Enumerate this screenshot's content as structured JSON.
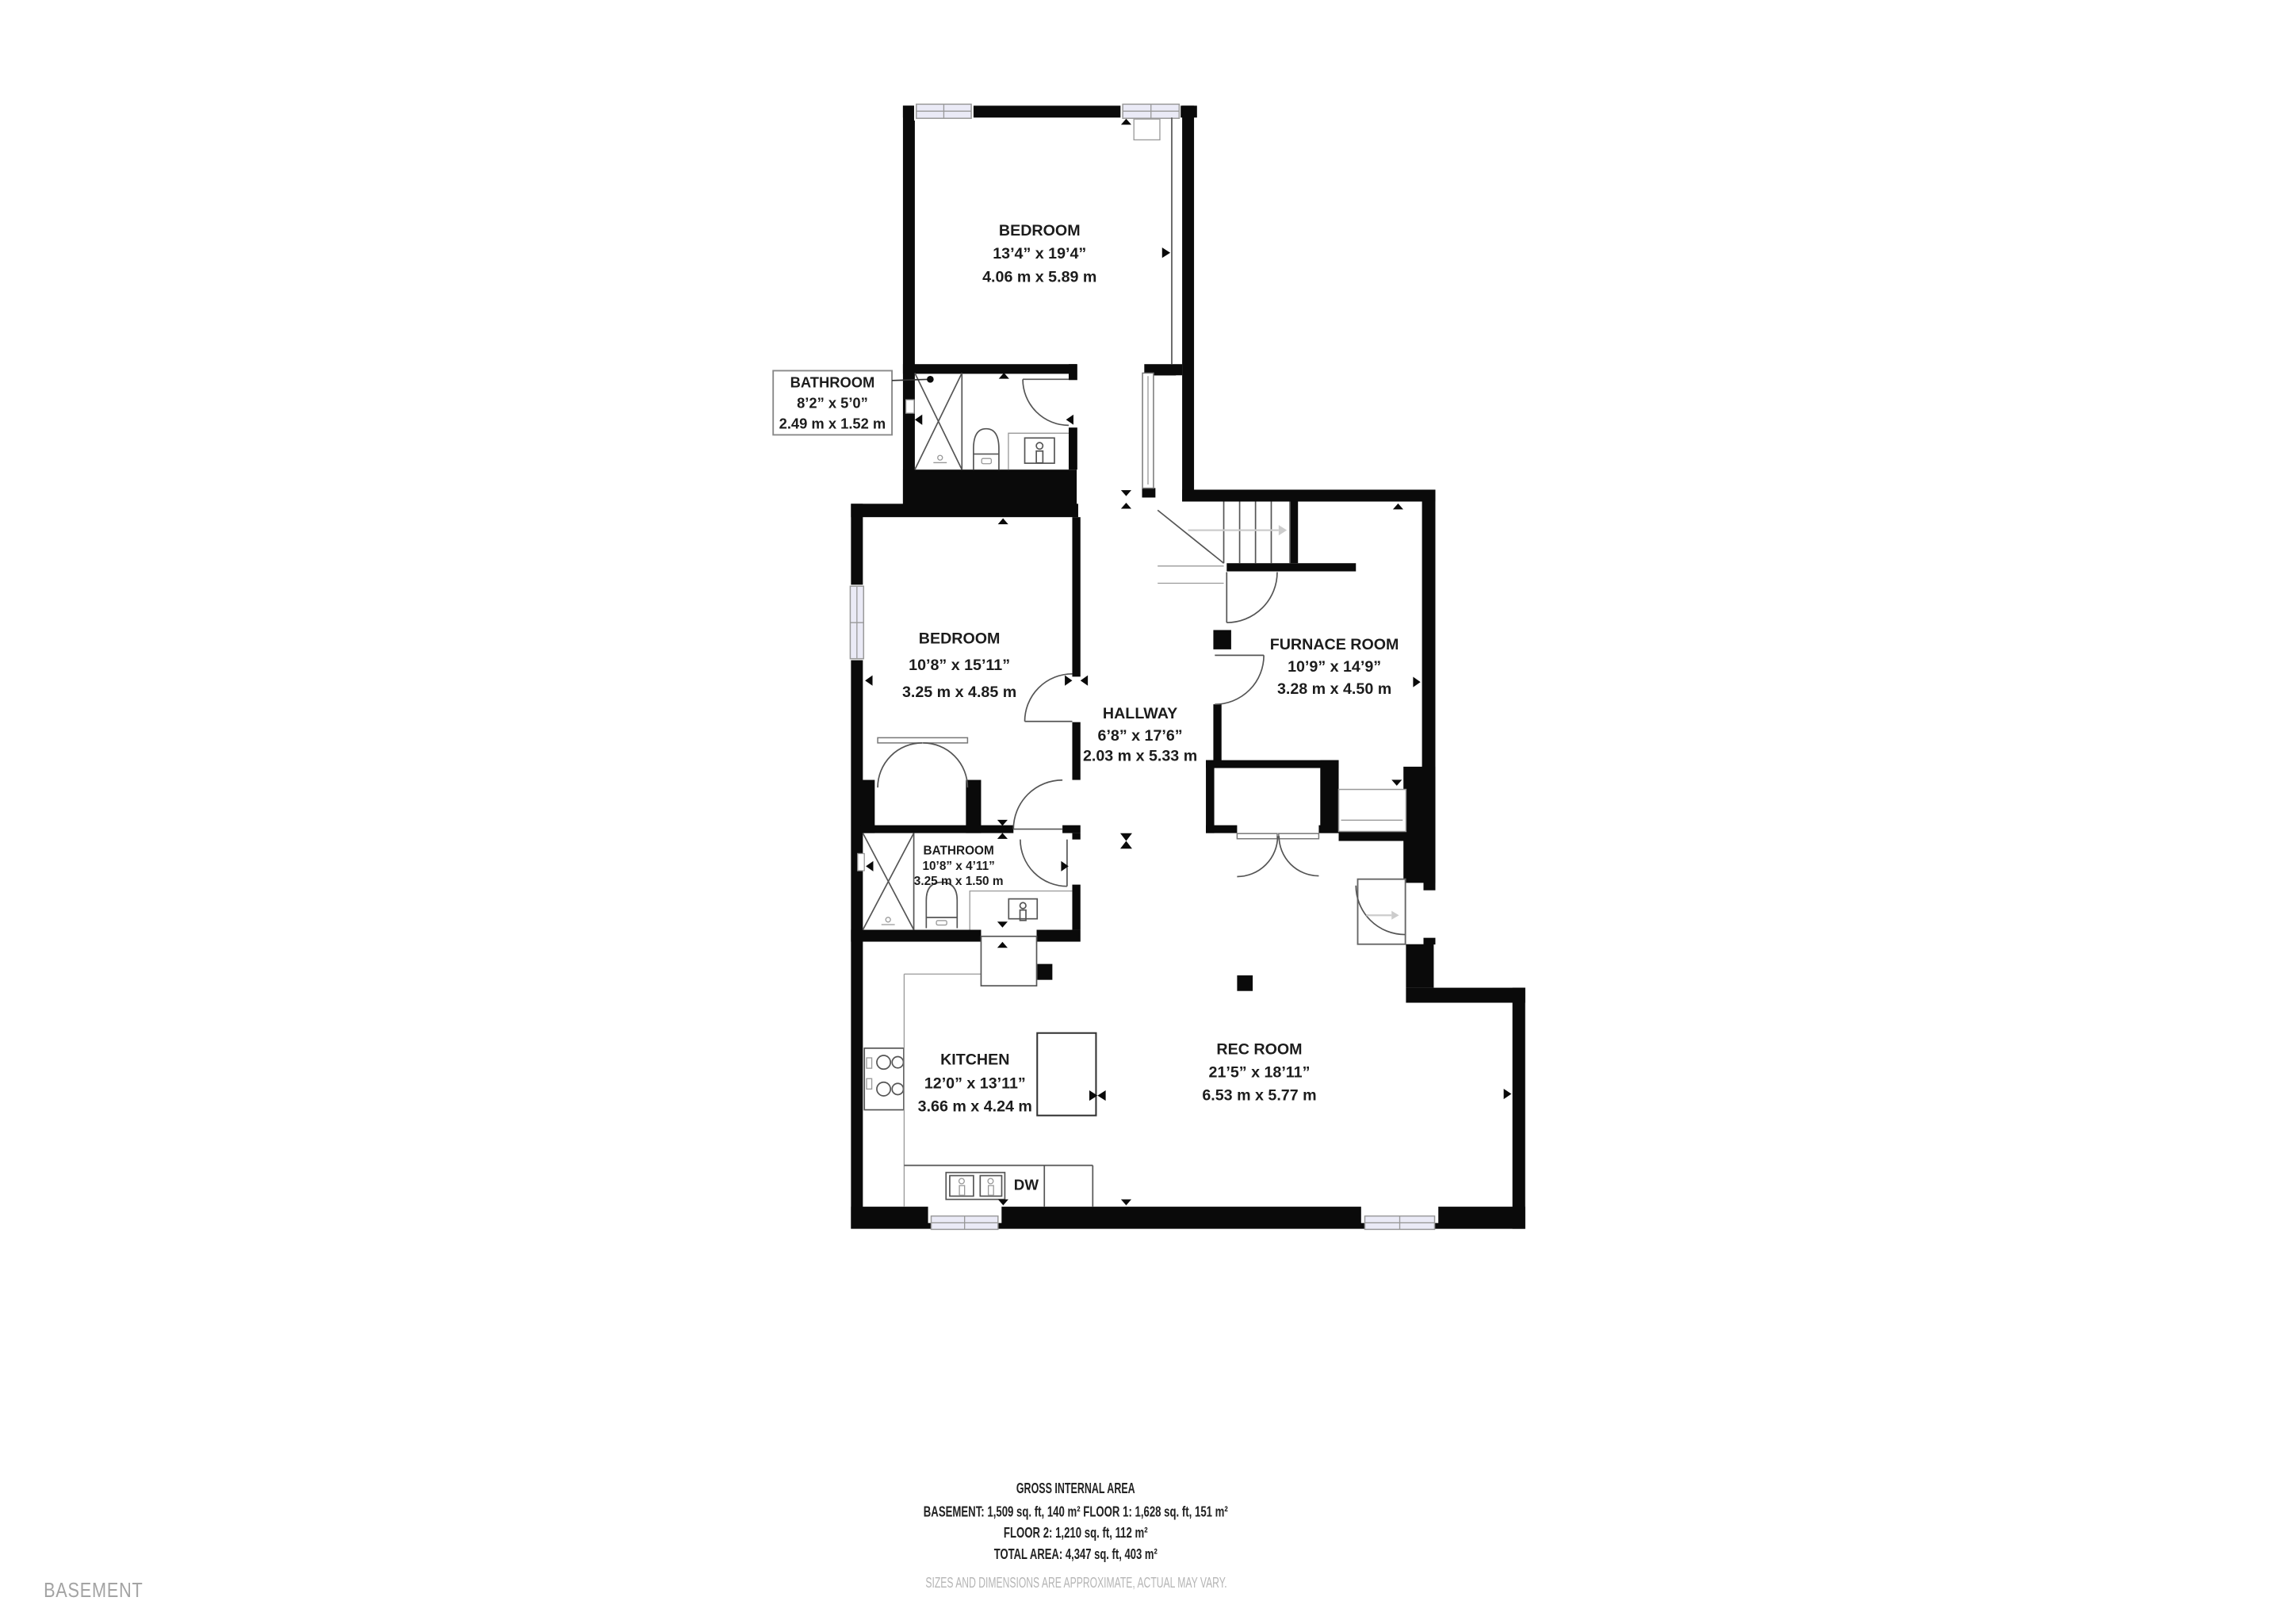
{
  "floor_label": "BASEMENT",
  "rooms": [
    {
      "name": "BEDROOM",
      "imperial": "13’4” x 19’4”",
      "metric": "4.06 m x 5.89 m"
    },
    {
      "name": "BATHROOM",
      "imperial": "8’2” x 5’0”",
      "metric": "2.49 m x 1.52 m"
    },
    {
      "name": "BEDROOM",
      "imperial": "10’8” x 15’11”",
      "metric": "3.25 m x 4.85 m"
    },
    {
      "name": "HALLWAY",
      "imperial": "6’8” x 17’6”",
      "metric": "2.03 m x 5.33 m"
    },
    {
      "name": "FURNACE ROOM",
      "imperial": "10’9” x 14’9”",
      "metric": "3.28 m x 4.50 m"
    },
    {
      "name": "BATHROOM",
      "imperial": "10’8” x 4’11”",
      "metric": "3.25 m x 1.50 m"
    },
    {
      "name": "KITCHEN",
      "imperial": "12’0” x 13’11”",
      "metric": "3.66 m x 4.24 m"
    },
    {
      "name": "REC ROOM",
      "imperial": "21’5” x 18’11”",
      "metric": "6.53 m x 5.77 m"
    }
  ],
  "appliances": {
    "dishwasher": "DW"
  },
  "footer": {
    "title": "GROSS INTERNAL AREA",
    "line1": "BASEMENT: 1,509 sq. ft, 140 m² FLOOR 1: 1,628 sq. ft, 151 m²",
    "line2": "FLOOR 2: 1,210 sq. ft, 112 m²",
    "line3": "TOTAL AREA: 4,347 sq. ft, 403 m²",
    "disclaimer": "SIZES AND DIMENSIONS ARE APPROXIMATE, ACTUAL MAY VARY."
  },
  "colors": {
    "wall": "#0a0a0a",
    "window_pane": "#eaeaf6",
    "muted_text": "#b5b5b5",
    "floor_tag": "#a3a3a3"
  }
}
